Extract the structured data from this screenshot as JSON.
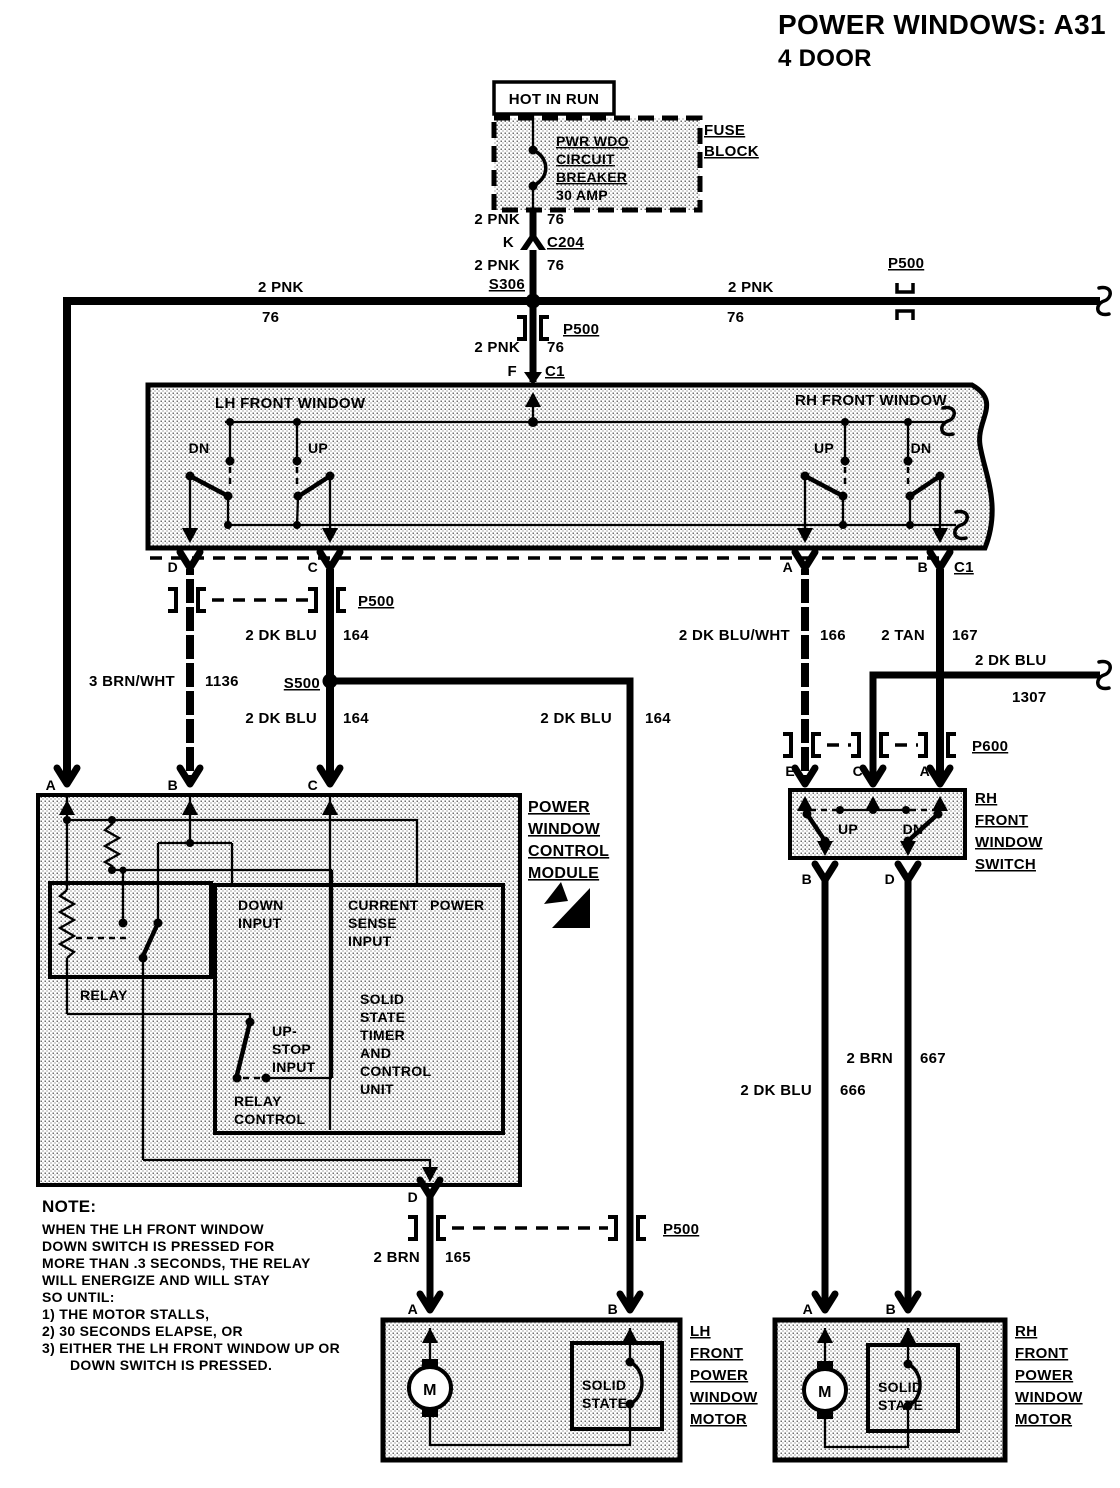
{
  "colors": {
    "ink": "#000000",
    "paper": "#ffffff",
    "halftone": "#c9c9c9"
  },
  "title": {
    "line1": "POWER WINDOWS: A31",
    "line2": "4 DOOR"
  },
  "fuse": {
    "hot_in_run": "HOT IN RUN",
    "breaker_lines": [
      "PWR WDO",
      "CIRCUIT",
      "BREAKER",
      "30 AMP"
    ],
    "block_label": [
      "FUSE",
      "BLOCK"
    ]
  },
  "connectors": {
    "k_pin": "K",
    "c204": "C204",
    "s306": "S306",
    "p500": "P500",
    "f_pin": "F",
    "c1": "C1",
    "s500": "S500",
    "p600": "P600"
  },
  "wire_labels": {
    "pnk": "2 PNK",
    "pnk_ckt": "76",
    "dkblu": "2 DK BLU",
    "dkblu_ckt": "164",
    "brnwht": "3 BRN/WHT",
    "brnwht_ckt": "1136",
    "dkbluwht": "2 DK BLU/WHT",
    "dkbluwht_ckt": "166",
    "tan": "2 TAN",
    "tan_ckt": "167",
    "dkblu_rh": "2 DK BLU",
    "dkblu_rh_ckt": "1307",
    "brn": "2 BRN",
    "brn_ckt": "165",
    "dkblu_mtr": "2 DK BLU",
    "dkblu_mtr_ckt": "666",
    "brn_mtr": "2 BRN",
    "brn_mtr_ckt": "667"
  },
  "window_switch": {
    "lh_title": "LH FRONT WINDOW",
    "rh_title": "RH FRONT WINDOW",
    "dn": "DN",
    "up": "UP",
    "pins": {
      "d": "D",
      "c": "C",
      "a": "A",
      "b": "B"
    }
  },
  "module": {
    "label": [
      "POWER",
      "WINDOW",
      "CONTROL",
      "MODULE"
    ],
    "pins": {
      "a": "A",
      "b": "B",
      "c": "C",
      "d": "D"
    },
    "relay": "RELAY",
    "down_input": [
      "DOWN",
      "INPUT"
    ],
    "current_sense": [
      "CURRENT",
      "SENSE",
      "INPUT"
    ],
    "power": "POWER",
    "solid_state_unit": [
      "SOLID",
      "STATE",
      "TIMER",
      "AND",
      "CONTROL",
      "UNIT"
    ],
    "up_stop": [
      "UP-",
      "STOP",
      "INPUT"
    ],
    "relay_control": [
      "RELAY",
      "CONTROL"
    ]
  },
  "rh_switch": {
    "label": [
      "RH",
      "FRONT",
      "WINDOW",
      "SWITCH"
    ],
    "up": "UP",
    "dn": "DN",
    "pins": {
      "e": "E",
      "c": "C",
      "a": "A",
      "b": "B",
      "d": "D"
    }
  },
  "lh_motor": {
    "label": [
      "LH",
      "FRONT",
      "POWER",
      "WINDOW",
      "MOTOR"
    ],
    "m": "M",
    "solid_state": [
      "SOLID",
      "STATE"
    ],
    "pins": {
      "a": "A",
      "b": "B"
    }
  },
  "rh_motor": {
    "label": [
      "RH",
      "FRONT",
      "POWER",
      "WINDOW",
      "MOTOR"
    ],
    "m": "M",
    "solid_state": [
      "SOLID",
      "STATE"
    ],
    "pins": {
      "a": "A",
      "b": "B"
    }
  },
  "note": {
    "heading": "NOTE:",
    "lines": [
      "WHEN THE LH FRONT WINDOW",
      "DOWN SWITCH IS PRESSED FOR",
      "MORE THAN .3 SECONDS, THE RELAY",
      "WILL ENERGIZE AND WILL STAY",
      "SO UNTIL:",
      "1) THE MOTOR STALLS,",
      "2) 30 SECONDS ELAPSE, OR",
      "3) EITHER THE LH FRONT WINDOW UP OR",
      "DOWN SWITCH IS PRESSED."
    ]
  }
}
